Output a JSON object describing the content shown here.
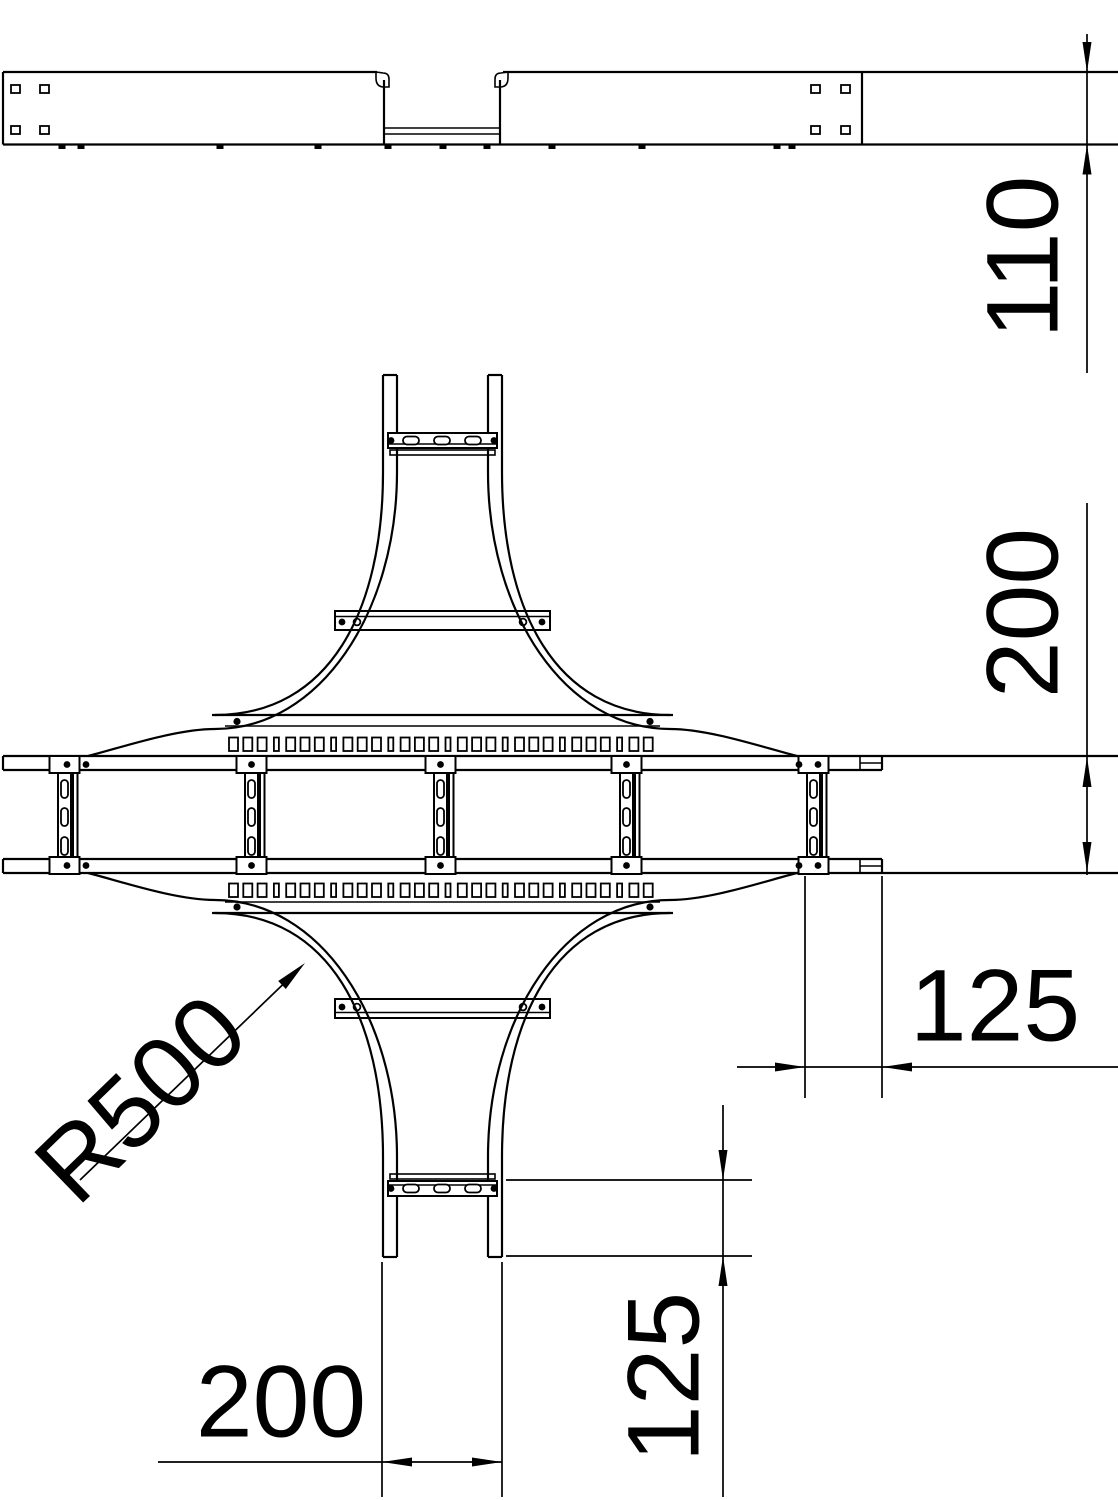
{
  "drawing": {
    "background_color": "#ffffff",
    "line_color": "#000000",
    "dimension_labels": {
      "side_height": "110",
      "run_width": "200",
      "right_end_length": "125",
      "bottom_arm_width": "200",
      "bottom_end_length": "125",
      "corner_radius": "R500"
    }
  }
}
